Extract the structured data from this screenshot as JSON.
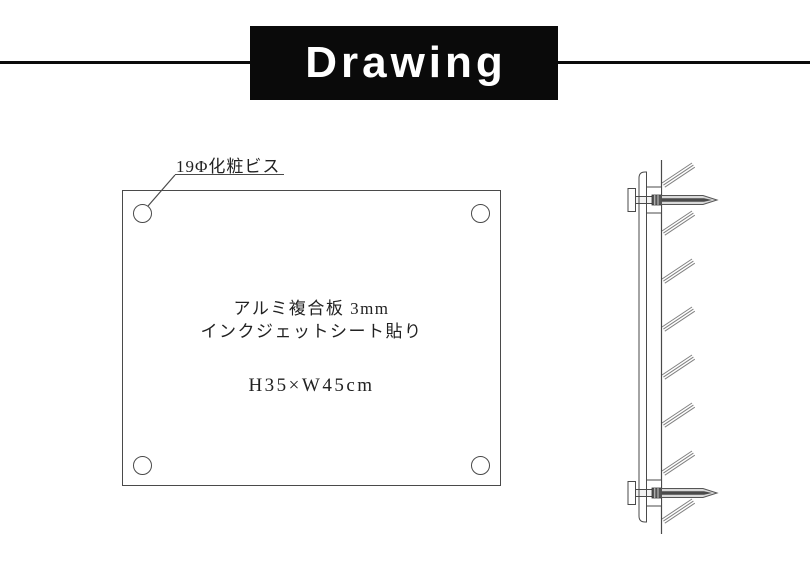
{
  "header": {
    "title": "Drawing",
    "bar_color": "#0a0a0a",
    "text_color": "#ffffff"
  },
  "front_view": {
    "callout_label": "19Φ化粧ビス",
    "material_line1": "アルミ複合板 3mm",
    "material_line2": "インクジェットシート貼り",
    "size_label": "H35×W45cm",
    "corner_screw_count": 4
  },
  "side_view": {
    "wall_hatch_count": 8,
    "anchor_bolt_count": 2
  },
  "colors": {
    "outline": "#4a4a4a",
    "hatch": "#808080",
    "anchor_fill": "#d9d9d9",
    "anchor_core": "#4a4a4a",
    "thread_block": "#555555",
    "text": "#222222"
  }
}
